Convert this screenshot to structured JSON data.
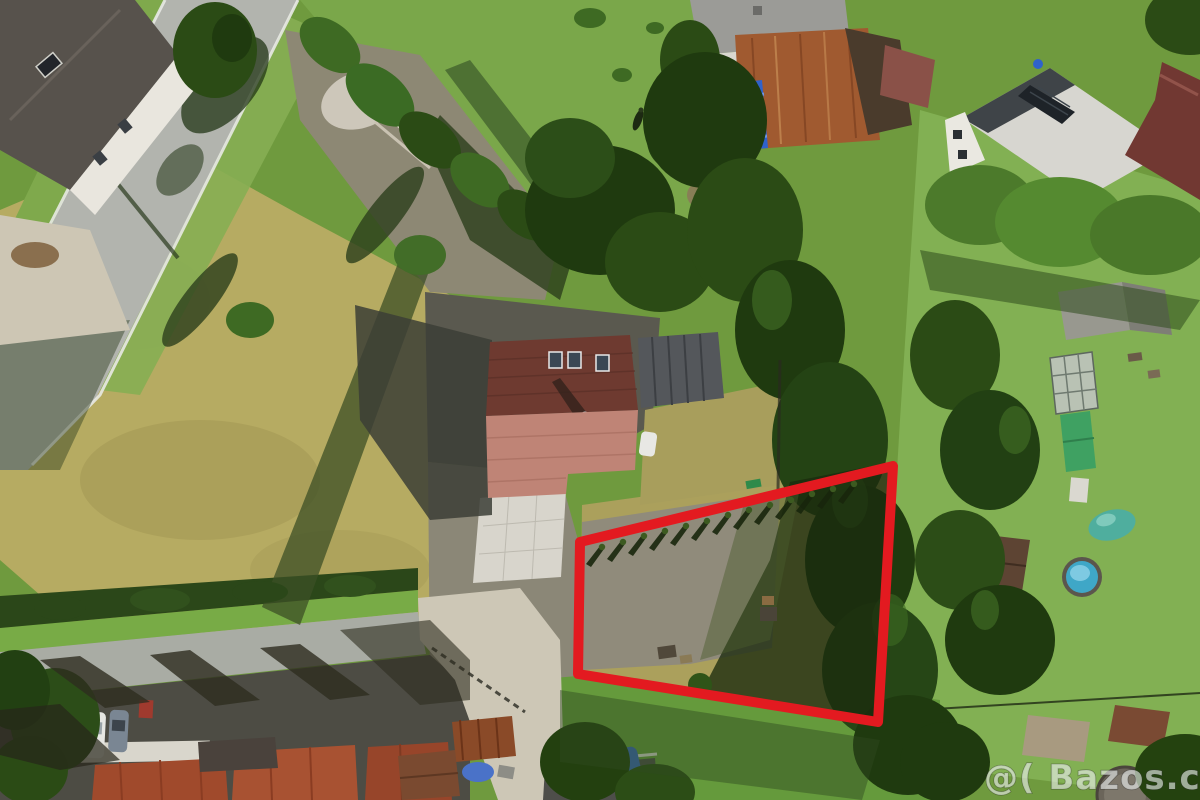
{
  "meta": {
    "description": "Aerial drone photograph of a building plot for sale, boundary of offered parcel marked with a red outline",
    "width_px": 1200,
    "height_px": 800
  },
  "watermark": {
    "text": "@( Bazos.cz",
    "color": "#edf0f0"
  },
  "plot_outline": {
    "points": "580,542 893,466 878,722 578,674",
    "color": "#e31a20",
    "stroke_width": 10
  },
  "palette": {
    "grass_base": "#6f9a3e",
    "grass_bright": "#7fae4c",
    "meadow_dry": "#b6ab62",
    "plot_gravel": "#908b7b",
    "road_gray": "#b2b4ae",
    "street_gray": "#a9aca4",
    "asphalt_dark": "#5a594f",
    "tree_dark": "#1f3a0f",
    "roof_dark_red": "#6e3a30",
    "roof_salmon": "#bf8476",
    "roof_rust": "#a05a30",
    "roof_metal": "#54575b",
    "tarp_blue": "#2f62cc",
    "pool_water": "#3fa7c7",
    "outline_red": "#e31a20"
  },
  "scene": {
    "regions": [
      {
        "name": "top-left-road",
        "color": "#b2b4ae"
      },
      {
        "name": "top-left-house-gray-roof",
        "color": "#57524c"
      },
      {
        "name": "dry-meadow-west",
        "color": "#b6ab62"
      },
      {
        "name": "concrete-pad",
        "color": "#dedbd2"
      },
      {
        "name": "main-house-dark-roof",
        "color": "#6e3a30"
      },
      {
        "name": "main-house-salmon-roof",
        "color": "#bf8476"
      },
      {
        "name": "metal-annex-roof",
        "color": "#54575b"
      },
      {
        "name": "paver-patio",
        "color": "#d8d5cc"
      },
      {
        "name": "farm-complex-rust-roof",
        "color": "#a05a30"
      },
      {
        "name": "farm-complex-blue-tarp",
        "color": "#2f62cc"
      },
      {
        "name": "white-house-solar-roof",
        "color": "#d7d6d0"
      },
      {
        "name": "marked-plot-gravel",
        "color": "#908b7b"
      },
      {
        "name": "marked-plot-dry-grass",
        "color": "#aba05c"
      },
      {
        "name": "east-hedge-trees",
        "color": "#1f3a0f"
      },
      {
        "name": "garden-round-pool",
        "color": "#3fa7c7"
      },
      {
        "name": "bottom-street",
        "color": "#a9aca4"
      },
      {
        "name": "rowhouse-red-roofs",
        "color": "#a04a2c"
      }
    ]
  }
}
